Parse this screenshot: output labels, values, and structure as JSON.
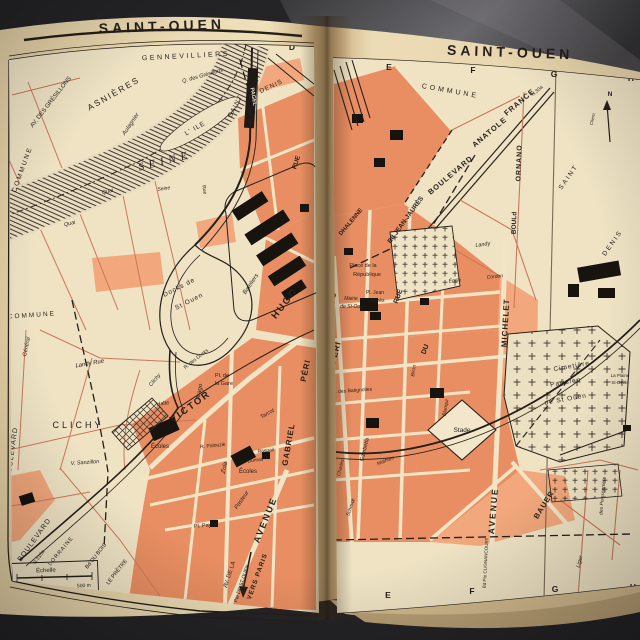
{
  "book": {
    "left_page_title": "SAINT-OUEN",
    "right_page_title": "SAINT-OUEN"
  },
  "colors": {
    "paper": "#e7d5ad",
    "map_paper": "#efe3c4",
    "orange": "#e98e62",
    "orange_light": "#f2a87c",
    "ink": "#241f1a",
    "red_street": "#c9785a",
    "table_dark": "#232224",
    "table_light": "#5a595d",
    "page_edge": "#d6bf96",
    "label_on_black": "#f0e6cc"
  },
  "left_page": {
    "title": "SAINT-OUEN",
    "labels": [
      {
        "t": "A",
        "x": 44,
        "y": 52,
        "s": 8.5,
        "w": 700,
        "n": "grid-letter"
      },
      {
        "t": "B",
        "x": 118,
        "y": 45,
        "s": 8.5,
        "w": 700,
        "n": "grid-letter"
      },
      {
        "t": "C",
        "x": 205,
        "y": 43,
        "s": 8.5,
        "w": 700,
        "n": "grid-letter"
      },
      {
        "t": "D",
        "x": 292,
        "y": 50,
        "s": 8.5,
        "w": 700,
        "n": "grid-letter"
      },
      {
        "t": "A",
        "x": 67,
        "y": 597,
        "s": 8.5,
        "w": 700,
        "n": "grid-letter"
      },
      {
        "t": "B",
        "x": 125,
        "y": 606,
        "s": 8.5,
        "w": 700,
        "n": "grid-letter"
      },
      {
        "t": "C",
        "x": 183,
        "y": 614,
        "s": 8.5,
        "w": 700,
        "n": "grid-letter"
      },
      {
        "t": "D",
        "x": 277,
        "y": 618,
        "s": 8.5,
        "w": 700,
        "n": "grid-letter"
      },
      {
        "t": "GENNEVILLIERS",
        "x": 186,
        "y": 58,
        "r": -3,
        "s": 7,
        "ls": 2.5
      },
      {
        "t": "ASNIÈRES",
        "x": 115,
        "y": 96,
        "r": -30,
        "s": 8.5,
        "ls": 2
      },
      {
        "t": "AV. DES GRÉSILLONS",
        "x": 52,
        "y": 103,
        "r": -52,
        "s": 6
      },
      {
        "t": "Q. des Grésillons",
        "x": 203,
        "y": 77,
        "r": -16,
        "s": 5.5,
        "i": 1
      },
      {
        "t": "Aulagnier",
        "x": 132,
        "y": 125,
        "r": -56,
        "s": 6,
        "i": 1
      },
      {
        "t": "SEINE",
        "x": 166,
        "y": 164,
        "r": -14,
        "s": 11,
        "i": 1,
        "f": "serif",
        "ls": 5
      },
      {
        "t": "L' ILE",
        "x": 196,
        "y": 130,
        "r": -30,
        "s": 6.5,
        "ls": 1
      },
      {
        "t": "SAINT",
        "x": 237,
        "y": 107,
        "r": -62,
        "s": 6.5,
        "ls": 1
      },
      {
        "t": "DENIS",
        "x": 272,
        "y": 88,
        "r": -25,
        "s": 6.5,
        "ls": 1
      },
      {
        "t": "PAGEL",
        "x": 252,
        "y": 97,
        "r": 80,
        "s": 5.5,
        "w": 700,
        "c": "#f0e6cc"
      },
      {
        "t": "COMMUNE",
        "x": 24,
        "y": 170,
        "r": -70,
        "s": 6.5,
        "ls": 2
      },
      {
        "t": "COMMUNE",
        "x": 32,
        "y": 317,
        "r": -4,
        "s": 6.5,
        "ls": 2
      },
      {
        "t": "Quai",
        "x": 108,
        "y": 193,
        "r": -14,
        "s": 5.5,
        "i": 1
      },
      {
        "t": "Quai",
        "x": 70,
        "y": 225,
        "r": -12,
        "s": 5.5,
        "i": 1
      },
      {
        "t": "Seine",
        "x": 164,
        "y": 190,
        "r": -8,
        "s": 5,
        "i": 1
      },
      {
        "t": "Rue",
        "x": 203,
        "y": 190,
        "r": 80,
        "s": 5
      },
      {
        "t": "Docks de",
        "x": 180,
        "y": 289,
        "r": -27,
        "s": 6.5,
        "ls": 1
      },
      {
        "t": "St Ouen",
        "x": 190,
        "y": 303,
        "r": -27,
        "s": 6.5,
        "ls": 1
      },
      {
        "t": "Bateliers",
        "x": 252,
        "y": 285,
        "r": -56,
        "s": 6,
        "i": 1
      },
      {
        "t": "Arago",
        "x": 201,
        "y": 392,
        "r": -80,
        "s": 6,
        "i": 1
      },
      {
        "t": "CLICHY",
        "x": 78,
        "y": 428,
        "s": 9,
        "ls": 3
      },
      {
        "t": "Landy  Rue",
        "x": 90,
        "y": 365,
        "r": -10,
        "s": 6,
        "i": 1
      },
      {
        "t": "Général",
        "x": 28,
        "y": 347,
        "r": -78,
        "s": 5.5,
        "i": 1
      },
      {
        "t": "V. Sanzillon",
        "x": 85,
        "y": 464,
        "r": -4,
        "s": 5.5,
        "i": 1
      },
      {
        "t": "BOULEVARD",
        "x": 14,
        "y": 453,
        "r": -82,
        "s": 7,
        "ls": 1
      },
      {
        "t": "Halte",
        "x": 163,
        "y": 405,
        "r": -8,
        "s": 5.5
      },
      {
        "t": "Clichy",
        "x": 156,
        "y": 381,
        "r": -50,
        "s": 5.5,
        "i": 1
      },
      {
        "t": "VICTOR",
        "x": 192,
        "y": 409,
        "r": -36,
        "s": 9.5,
        "w": 700,
        "ls": 2
      },
      {
        "t": "HUGO",
        "x": 287,
        "y": 305,
        "r": -52,
        "s": 9.5,
        "w": 700,
        "ls": 2
      },
      {
        "t": "Pl. de",
        "x": 222,
        "y": 377,
        "s": 5.5
      },
      {
        "t": "la Gare",
        "x": 224,
        "y": 385,
        "s": 5.5
      },
      {
        "t": "R. des Docks",
        "x": 197,
        "y": 360,
        "r": -38,
        "s": 5
      },
      {
        "t": "Écoles",
        "x": 160,
        "y": 448,
        "s": 6
      },
      {
        "t": "Écoles",
        "x": 248,
        "y": 473,
        "s": 6
      },
      {
        "t": "Zola",
        "x": 226,
        "y": 468,
        "r": -78,
        "s": 6,
        "i": 1
      },
      {
        "t": "Pasteur",
        "x": 243,
        "y": 501,
        "r": -55,
        "s": 6,
        "i": 1
      },
      {
        "t": "Tarcot",
        "x": 268,
        "y": 415,
        "r": -30,
        "s": 5.5,
        "i": 1
      },
      {
        "t": "Al. Dumas",
        "x": 252,
        "y": 462,
        "r": -8,
        "s": 5
      },
      {
        "t": "R. Palouzie",
        "x": 213,
        "y": 447,
        "r": -6,
        "s": 5
      },
      {
        "t": "Raspail",
        "x": 266,
        "y": 452,
        "r": -6,
        "s": 5
      },
      {
        "t": "GABRIEL",
        "x": 291,
        "y": 445,
        "r": -80,
        "s": 8,
        "w": 700,
        "ls": 1
      },
      {
        "t": "PÉRI",
        "x": 308,
        "y": 371,
        "r": -78,
        "s": 8,
        "w": 700,
        "ls": 1
      },
      {
        "t": "Pl. Payret",
        "x": 206,
        "y": 527,
        "r": -4,
        "s": 5.5
      },
      {
        "t": "AVENUE",
        "x": 268,
        "y": 521,
        "r": -68,
        "s": 9,
        "w": 700,
        "ls": 2
      },
      {
        "t": "AV. DE LA",
        "x": 231,
        "y": 575,
        "r": -72,
        "s": 6
      },
      {
        "t": "Pte DE ST OUEN",
        "x": 243,
        "y": 584,
        "r": -72,
        "s": 5
      },
      {
        "t": "VERS PARIS",
        "x": 259,
        "y": 577,
        "r": -70,
        "s": 6.5,
        "w": 700,
        "ls": 1
      },
      {
        "t": "BOULEVARD",
        "x": 36,
        "y": 541,
        "r": -54,
        "s": 7,
        "ls": 1
      },
      {
        "t": "N.310a",
        "x": 40,
        "y": 558,
        "r": -54,
        "s": 5
      },
      {
        "t": "LORRAINE",
        "x": 62,
        "y": 552,
        "r": -50,
        "s": 5.5,
        "ls": 1
      },
      {
        "t": "Bd DU BOIS",
        "x": 97,
        "y": 557,
        "r": -52,
        "s": 5.5
      },
      {
        "t": "LE PRÊTRE",
        "x": 118,
        "y": 573,
        "r": -52,
        "s": 5.5
      },
      {
        "t": "RUE",
        "x": 298,
        "y": 163,
        "r": -72,
        "s": 6.5,
        "w": 700
      },
      {
        "t": "Échelle",
        "x": 46,
        "y": 572,
        "r": -2,
        "s": 6
      },
      {
        "t": "500 m",
        "x": 84,
        "y": 587,
        "r": -3,
        "s": 5
      },
      {
        "t": "Prolongement Ligne 13",
        "x": 232,
        "y": 618,
        "r": -3,
        "s": 5
      }
    ]
  },
  "right_page": {
    "title": "SAINT-OUEN",
    "labels": [
      {
        "t": "E",
        "x": 389,
        "y": 70,
        "s": 8.5,
        "w": 700,
        "n": "grid-letter"
      },
      {
        "t": "F",
        "x": 473,
        "y": 73,
        "s": 8.5,
        "w": 700,
        "n": "grid-letter"
      },
      {
        "t": "G",
        "x": 554,
        "y": 77,
        "s": 8.5,
        "w": 700,
        "n": "grid-letter"
      },
      {
        "t": "H",
        "x": 631,
        "y": 81,
        "s": 8.5,
        "w": 700,
        "n": "grid-letter"
      },
      {
        "t": "E",
        "x": 388,
        "y": 598,
        "s": 8.5,
        "w": 700,
        "n": "grid-letter"
      },
      {
        "t": "F",
        "x": 472,
        "y": 594,
        "s": 8.5,
        "w": 700,
        "n": "grid-letter"
      },
      {
        "t": "G",
        "x": 555,
        "y": 592,
        "s": 8.5,
        "w": 700,
        "n": "grid-letter"
      },
      {
        "t": "H",
        "x": 633,
        "y": 590,
        "s": 8.5,
        "w": 700,
        "n": "grid-letter"
      },
      {
        "t": "COMMUNE",
        "x": 450,
        "y": 93,
        "r": 10,
        "s": 7,
        "ls": 3
      },
      {
        "t": "BOULEVARD",
        "x": 452,
        "y": 177,
        "r": -40,
        "s": 7.5,
        "w": 700,
        "ls": 1
      },
      {
        "t": "ANATOLE",
        "x": 491,
        "y": 134,
        "r": -40,
        "s": 7.5,
        "w": 700,
        "ls": 1
      },
      {
        "t": "FRANCE",
        "x": 521,
        "y": 104,
        "r": -40,
        "s": 7.5,
        "w": 700,
        "ls": 1
      },
      {
        "t": "N.30a",
        "x": 538,
        "y": 92,
        "r": -40,
        "s": 5
      },
      {
        "t": "Bd JEAN-JAURÈS",
        "x": 407,
        "y": 221,
        "r": -54,
        "s": 6.5,
        "w": 700
      },
      {
        "t": "BOULd",
        "x": 516,
        "y": 223,
        "r": -88,
        "s": 6.5,
        "w": 700
      },
      {
        "t": "ORNANO",
        "x": 521,
        "y": 163,
        "r": -88,
        "s": 7,
        "w": 700,
        "ls": 1
      },
      {
        "t": "SAINT",
        "x": 570,
        "y": 178,
        "r": -55,
        "s": 6.5,
        "ls": 2
      },
      {
        "t": "DENIS",
        "x": 614,
        "y": 244,
        "r": -55,
        "s": 6.5,
        "ls": 2
      },
      {
        "t": "N",
        "x": 610,
        "y": 96,
        "s": 6.5,
        "w": 700
      },
      {
        "t": "Chem.",
        "x": 594,
        "y": 119,
        "r": -78,
        "s": 4.5,
        "i": 1
      },
      {
        "t": "ALBT",
        "x": 330,
        "y": 197,
        "r": -48,
        "s": 6,
        "w": 700
      },
      {
        "t": "DHALENNE",
        "x": 352,
        "y": 223,
        "r": -50,
        "s": 6,
        "w": 700
      },
      {
        "t": "UGO",
        "x": 331,
        "y": 303,
        "r": -55,
        "s": 9,
        "w": 700,
        "ls": 1
      },
      {
        "t": "PÉRI",
        "x": 338,
        "y": 353,
        "r": -75,
        "s": 8,
        "w": 700,
        "ls": 1
      },
      {
        "t": "Place de la",
        "x": 363,
        "y": 267,
        "s": 5.5
      },
      {
        "t": "République",
        "x": 367,
        "y": 276,
        "s": 5.5
      },
      {
        "t": "Pl. Jean",
        "x": 375,
        "y": 294,
        "s": 5
      },
      {
        "t": "Jaurès",
        "x": 377,
        "y": 302,
        "s": 5
      },
      {
        "t": "Mairie",
        "x": 351,
        "y": 300,
        "s": 5,
        "i": 1
      },
      {
        "t": "de St-Ouen",
        "x": 353,
        "y": 308,
        "s": 5,
        "i": 1
      },
      {
        "t": "RUE",
        "x": 400,
        "y": 297,
        "r": -70,
        "s": 7,
        "w": 700
      },
      {
        "t": "DU",
        "x": 427,
        "y": 350,
        "r": -70,
        "s": 7,
        "w": 700
      },
      {
        "t": "Émile",
        "x": 455,
        "y": 282,
        "r": -5,
        "s": 5,
        "i": 1
      },
      {
        "t": "Cordon",
        "x": 495,
        "y": 278,
        "r": -5,
        "s": 5,
        "i": 1
      },
      {
        "t": "Landy",
        "x": 483,
        "y": 246,
        "r": -8,
        "s": 5.5,
        "i": 1
      },
      {
        "t": "MICHELET",
        "x": 508,
        "y": 323,
        "r": -87,
        "s": 8,
        "w": 700,
        "ls": 1
      },
      {
        "t": "Cimetière",
        "x": 572,
        "y": 368,
        "r": -10,
        "s": 6.5,
        "ls": 1
      },
      {
        "t": "Parisien",
        "x": 566,
        "y": 384,
        "r": -10,
        "s": 6.5,
        "ls": 1
      },
      {
        "t": "de St Ouen",
        "x": 566,
        "y": 401,
        "r": -10,
        "s": 6.5,
        "ls": 1
      },
      {
        "t": "La Plaine",
        "x": 620,
        "y": 377,
        "s": 4.5
      },
      {
        "t": "St-Denis",
        "x": 620,
        "y": 384,
        "s": 4.5
      },
      {
        "t": "Stade",
        "x": 462,
        "y": 432,
        "s": 6.5
      },
      {
        "t": "Blanqui",
        "x": 447,
        "y": 408,
        "r": -80,
        "s": 5,
        "i": 1
      },
      {
        "t": "Gambetta",
        "x": 366,
        "y": 450,
        "r": -76,
        "s": 5.5,
        "i": 1
      },
      {
        "t": "Mathieu",
        "x": 386,
        "y": 462,
        "r": -22,
        "s": 5,
        "i": 1
      },
      {
        "t": "Charles",
        "x": 342,
        "y": 468,
        "r": -76,
        "s": 5,
        "i": 1
      },
      {
        "t": "Schmidt",
        "x": 352,
        "y": 508,
        "r": -70,
        "s": 5,
        "i": 1
      },
      {
        "t": "R. des Batignolles",
        "x": 352,
        "y": 392,
        "r": -4,
        "s": 5
      },
      {
        "t": "Biron",
        "x": 415,
        "y": 371,
        "r": -80,
        "s": 5,
        "i": 1
      },
      {
        "t": "AVENUE",
        "x": 496,
        "y": 511,
        "r": -85,
        "s": 8.5,
        "w": 700,
        "ls": 2
      },
      {
        "t": "BAUER",
        "x": 546,
        "y": 506,
        "r": -58,
        "s": 7.5,
        "w": 700,
        "ls": 1
      },
      {
        "t": "Liger",
        "x": 581,
        "y": 562,
        "r": -75,
        "s": 5.5,
        "i": 1
      },
      {
        "t": "Bd Pte CLIGNANCOURT",
        "x": 487,
        "y": 563,
        "r": -87,
        "s": 4.5
      },
      {
        "t": "des Poissonniers",
        "x": 604,
        "y": 496,
        "r": -85,
        "s": 5,
        "i": 1
      }
    ]
  }
}
